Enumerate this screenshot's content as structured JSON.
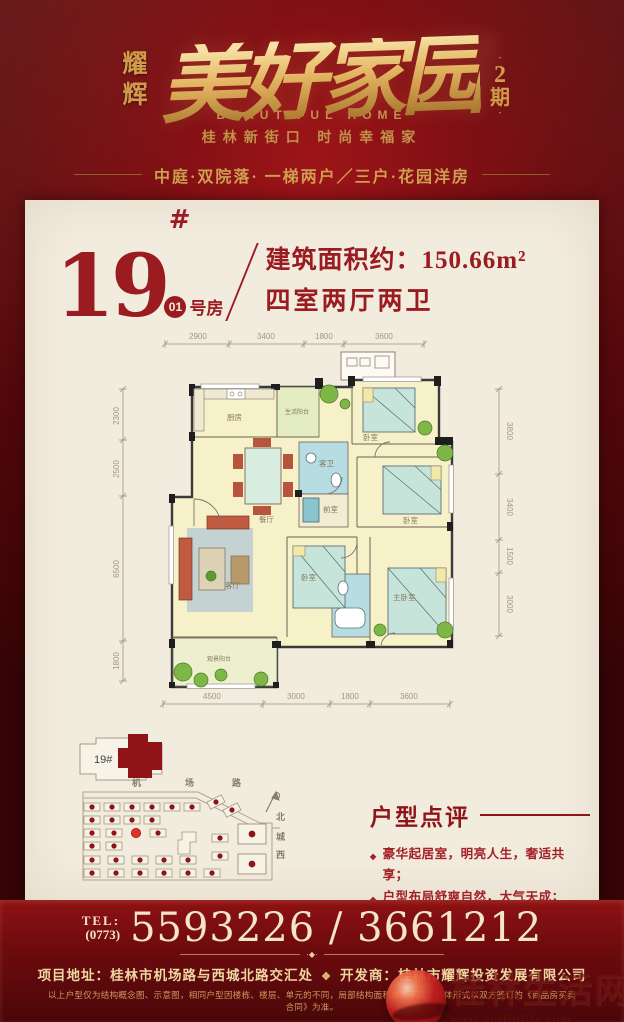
{
  "header": {
    "brand_vertical": "耀辉",
    "title_calligraphy": "美好家园",
    "phase_dot": "·",
    "phase_number": "2",
    "phase_label": "期",
    "subtitle_en": "BEAUTIFUL HOME",
    "subtitle_cn": "桂林新街口 时尚幸福家",
    "tagline": "中庭·双院落· 一梯两户／三户·花园洋房"
  },
  "unit": {
    "number": "19",
    "hash": "#",
    "room_badge": "01",
    "room_label": "号房",
    "area_line": "建筑面积约：150.66m²",
    "layout_line": "四室两厅两卫"
  },
  "floorplan": {
    "dims": {
      "top": [
        "2900",
        "3400",
        "1800",
        "3600"
      ],
      "left": [
        "2300",
        "2500",
        "6500",
        "1800"
      ],
      "bottom": [
        "4500",
        "3000",
        "1800",
        "3600"
      ],
      "right": [
        "3800",
        "3400",
        "1500",
        "3000"
      ]
    },
    "rooms": {
      "kitchen": "厨房",
      "service_balcony": "生活阳台",
      "bedroom_top": "卧室",
      "guest_bath": "客卫",
      "anteroom": "前室",
      "dining": "餐厅",
      "bedroom_right": "卧室",
      "living": "客厅",
      "bedroom_mid": "卧室",
      "master_bedroom": "主卧室",
      "view_balcony": "观景阳台"
    }
  },
  "sitemap": {
    "inset_label": "19#",
    "road_top_chars": [
      "机",
      "场",
      "路"
    ],
    "road_right_chars": [
      "北",
      "城",
      "西"
    ]
  },
  "review": {
    "title": "户型点评",
    "bullet": "◆",
    "points": [
      "豪华起居室，明亮人生，奢适共享；",
      "户型布局舒爽自然，大气天成；",
      "豪华客厅外接观景阳台，会客品茶，品味生活，尽显世家大户风范。"
    ]
  },
  "footer": {
    "tel_label": "TEL:",
    "tel_area": "(0773)",
    "tel_numbers": "5593226 / 3661212",
    "divider_mark": "·◆·",
    "address_label": "项目地址：",
    "address": "桂林市机场路与西城北路交汇处",
    "ornament": "❖",
    "developer_label": "开发商：",
    "developer": "桂林市耀辉投资发展有限公司",
    "disclaimer": "以上户型仅为结构概念图、示意图，相同户型因楼栋、楼层、单元的不同，局部结构面积有所不同，具体形式以双方签订的《商品房买卖合同》为准。"
  },
  "watermark": {
    "site_name": "桂林生活网",
    "site_url": "www.guilinlife.com"
  },
  "colors": {
    "background_red": "#7c0f13",
    "gold": "#cf9c4c",
    "card_cream": "#f2ecdf",
    "deep_red_text": "#9a1b20",
    "plan_room_yellow": "#f7f1c9",
    "plan_bath_blue": "#b7dde2",
    "plan_green": "#7fb648"
  }
}
